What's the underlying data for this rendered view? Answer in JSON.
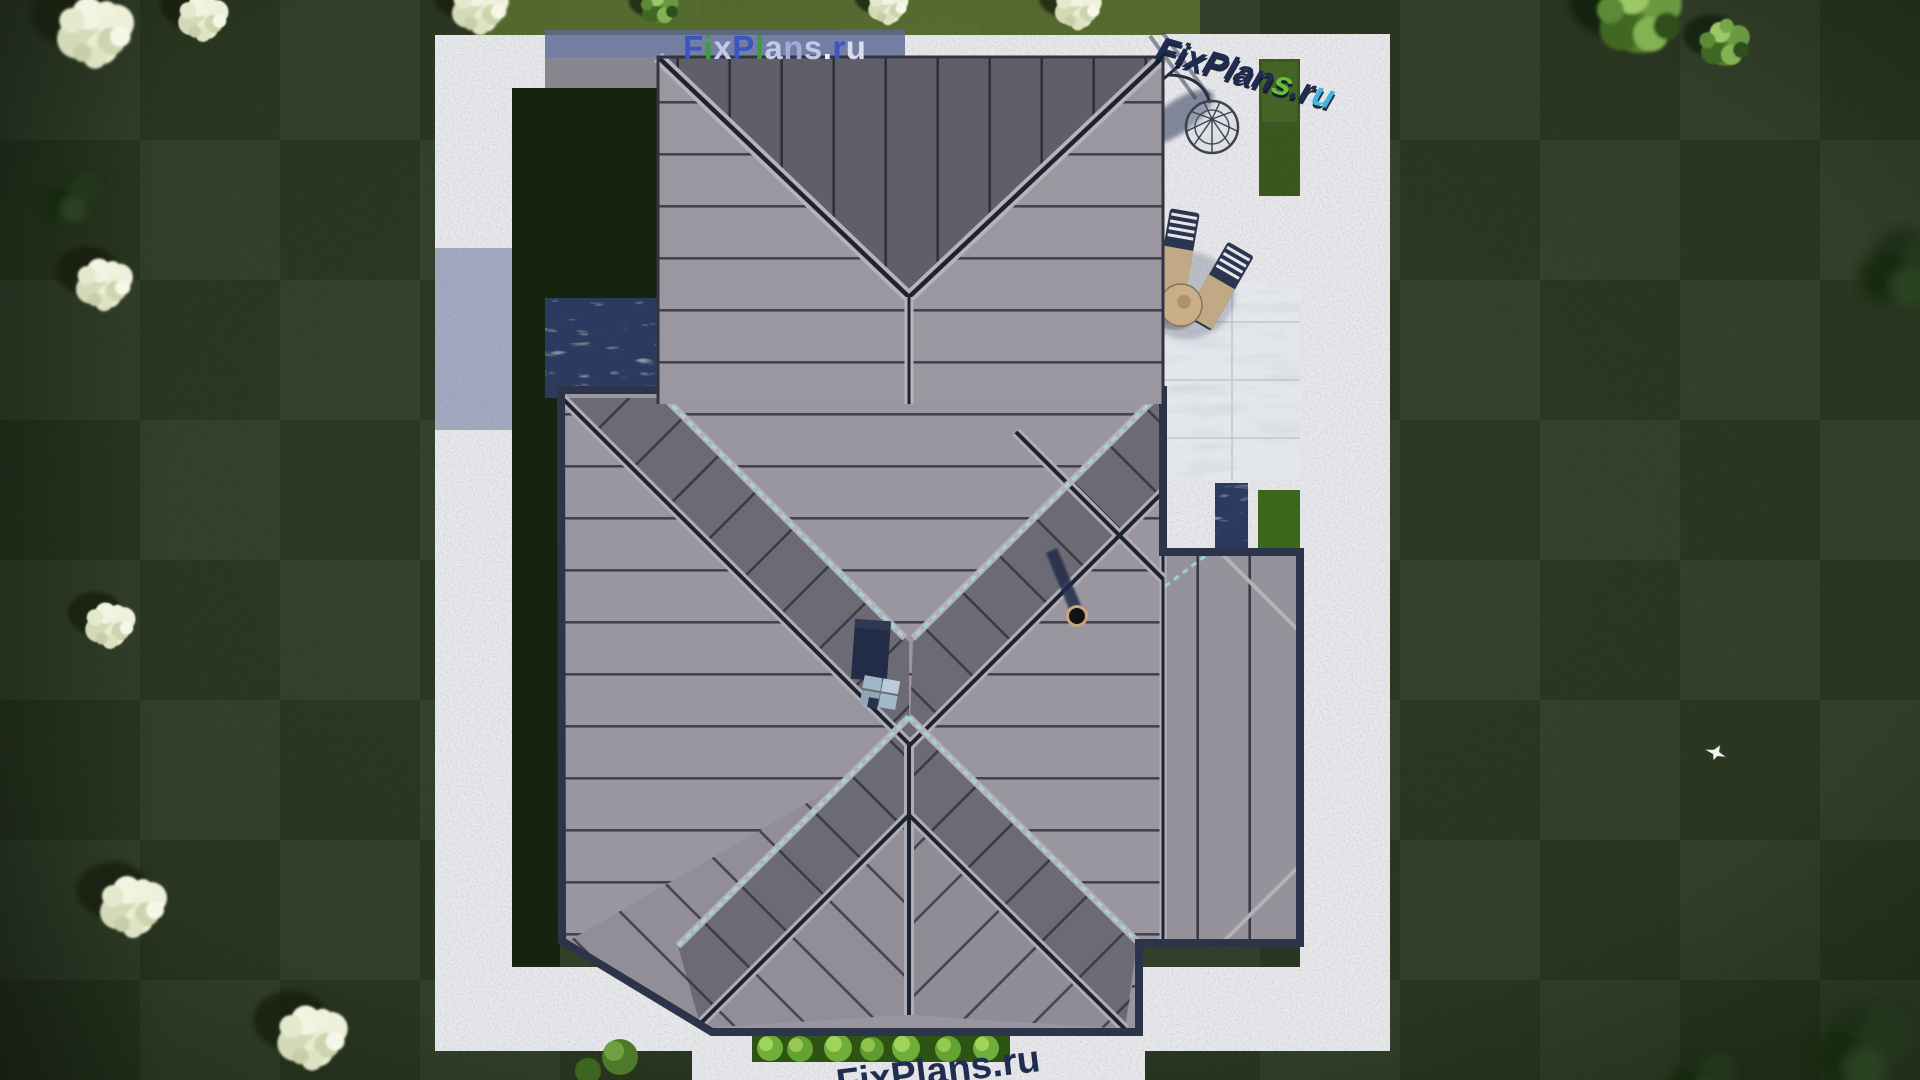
{
  "scene_title": "aerial-roof-plan-render",
  "watermarks": {
    "main": {
      "text": "FixPlans.ru",
      "letters": [
        {
          "ch": "F",
          "color": "#3b55c4"
        },
        {
          "ch": "i",
          "color": "#3a9e3a"
        },
        {
          "ch": "x",
          "color": "#c2cae8"
        },
        {
          "ch": "P",
          "color": "#3b55c4"
        },
        {
          "ch": "l",
          "color": "#3a9e3a"
        },
        {
          "ch": "a",
          "color": "#c2cae8"
        },
        {
          "ch": "n",
          "color": "#9fabd9"
        },
        {
          "ch": "s",
          "color": "#c2cae8"
        },
        {
          "ch": ".",
          "color": "#eef0f8"
        },
        {
          "ch": "r",
          "color": "#3b55c4"
        },
        {
          "ch": "u",
          "color": "#d8dcf0"
        }
      ]
    },
    "corner3d": {
      "text": "FixPlans.ru",
      "letters": [
        {
          "ch": "F",
          "color": "#1e2c50"
        },
        {
          "ch": "i",
          "color": "#1e2c50"
        },
        {
          "ch": "x",
          "color": "#1e2c50"
        },
        {
          "ch": "P",
          "color": "#1e2c50"
        },
        {
          "ch": "l",
          "color": "#1e2c50"
        },
        {
          "ch": "a",
          "color": "#1e2c50"
        },
        {
          "ch": "n",
          "color": "#1e2c50"
        },
        {
          "ch": "s",
          "color": "#6abf3a"
        },
        {
          "ch": ".",
          "color": "#1e2c50"
        },
        {
          "ch": "r",
          "color": "#1e2c50"
        },
        {
          "ch": "u",
          "color": "#3fb5e0"
        }
      ]
    },
    "bottom": {
      "text": "FixPlans.ru",
      "letters": [
        {
          "ch": "F",
          "color": "#1f2d52"
        },
        {
          "ch": "i",
          "color": "#1f2d52"
        },
        {
          "ch": "x",
          "color": "#1f2d52"
        },
        {
          "ch": "P",
          "color": "#1f2d52"
        },
        {
          "ch": "l",
          "color": "#1f2d52"
        },
        {
          "ch": "a",
          "color": "#1f2d52"
        },
        {
          "ch": "n",
          "color": "#1f2d52"
        },
        {
          "ch": "s",
          "color": "#1f2d52"
        },
        {
          "ch": ".",
          "color": "#1f2d52"
        },
        {
          "ch": "r",
          "color": "#1f2d52"
        },
        {
          "ch": "u",
          "color": "#1f2d52"
        }
      ]
    }
  },
  "palette": {
    "grass": "#2e3a25",
    "grass_shaded": "#16240f",
    "concrete": "#e9e9ec",
    "concrete_shadow": "#5c6892",
    "marble": "#e3e6ea",
    "roof_light": "#9a96a0",
    "roof_dark": "#5e5f69",
    "roof_band": "#6c6b75",
    "seam": "#2a2b36",
    "valley_navy": "#1d2333",
    "ridge_cap": "#b3b0b7",
    "teal_flashing": "#9adbe0",
    "eave": "#2c3449",
    "hedge": "#6fae3a",
    "lounger_navy": "#2b3450",
    "cushion_tan": "#c2a986",
    "blossom_tree": "#e8ecd2"
  }
}
